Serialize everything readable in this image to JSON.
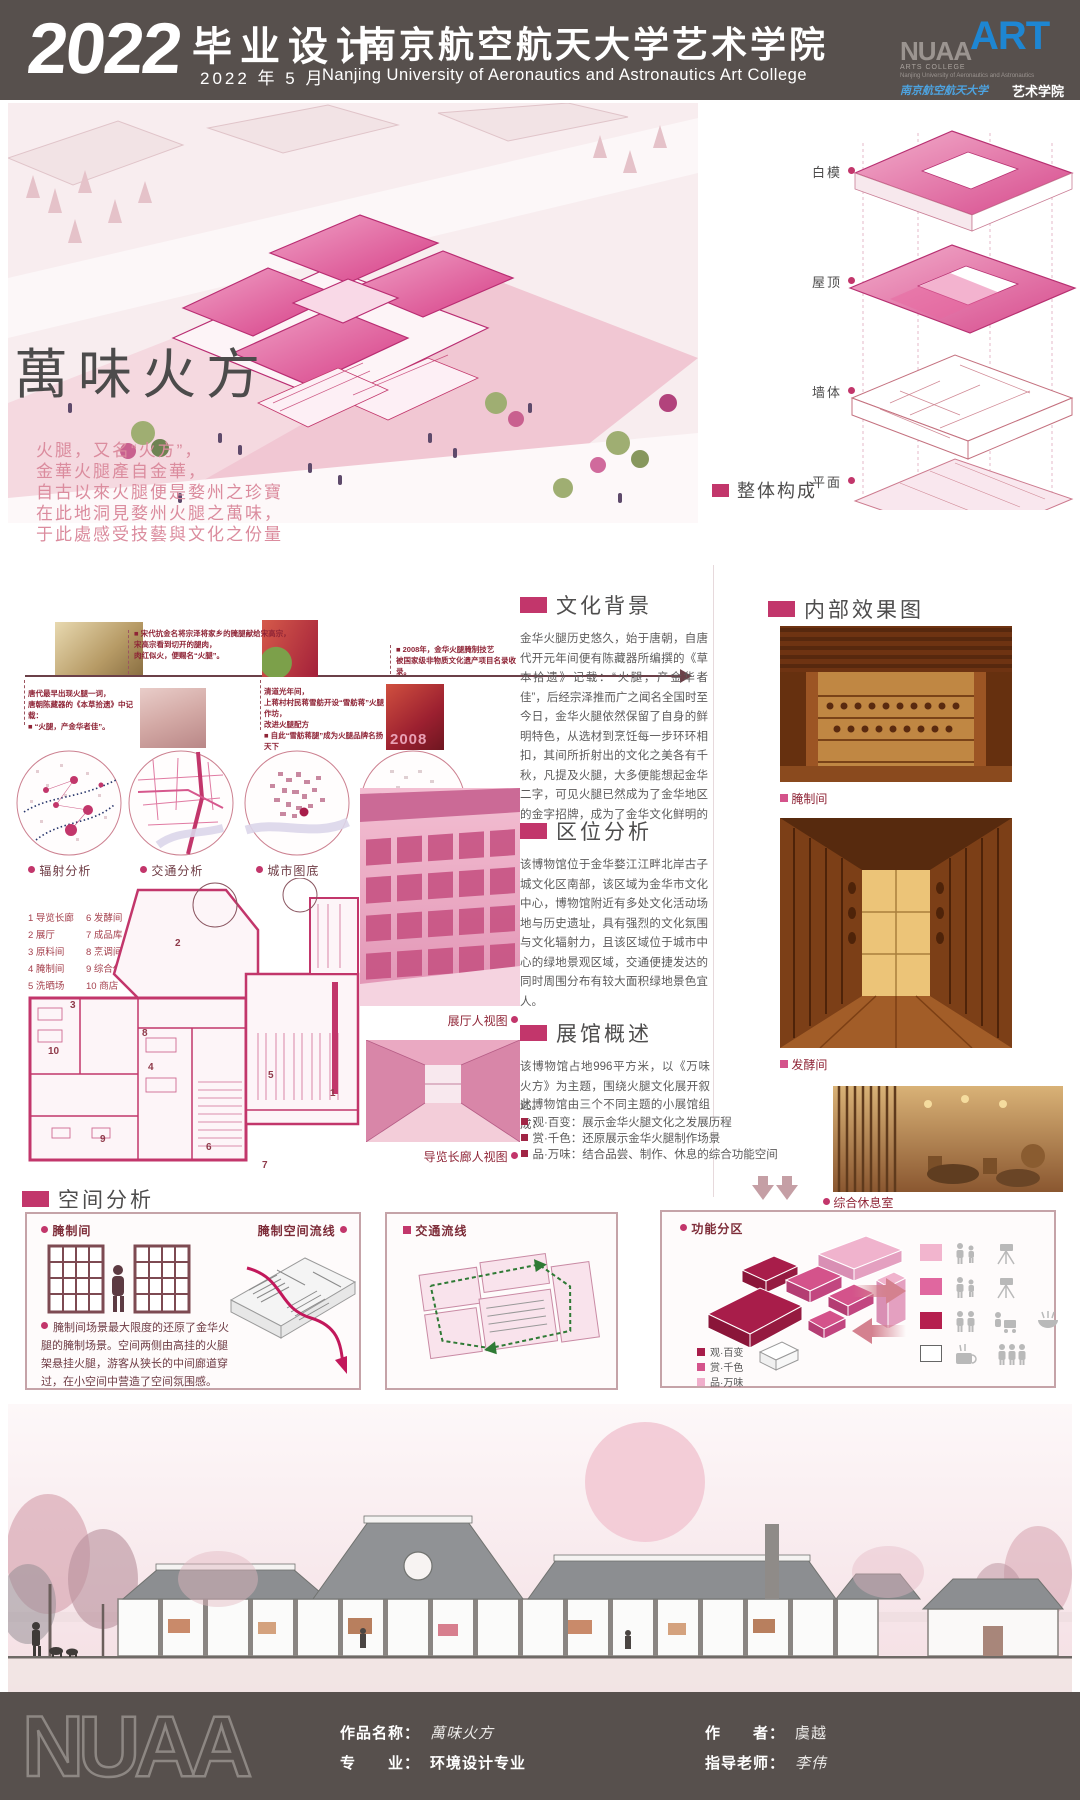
{
  "colors": {
    "accent": "#c2366b",
    "header_bar": "#57504d",
    "timeline_red": "#8f2436",
    "zone_dark": "#a81d4a",
    "zone_mid": "#d4538b",
    "zone_light": "#f0aecb",
    "logo_blue": "#1e86d2"
  },
  "header": {
    "year": "2022",
    "title": "毕业设计",
    "date": "2022 年 5 月",
    "school_cn": "南京航空航天大学艺术学院",
    "school_en": "Nanjing University of Aeronautics and Astronautics Art College",
    "logo": {
      "nuaa": "NUAA",
      "art": "ART",
      "arts_college": "ARTS COLLEGE",
      "uni_line": "Nanjing University  of Aeronautics and Astronautics",
      "calligraphy": "南京航空航天大学",
      "art_college": "艺术学院"
    }
  },
  "hero": {
    "title": "萬味火方",
    "lines": [
      "火腿，又名“火方”，",
      "金華火腿產自金華，",
      "自古以來火腿便是婺州之珍寶",
      "在此地洞見婺州火腿之萬味，",
      "于此處感受技藝與文化之份量"
    ]
  },
  "exploded": {
    "labels": [
      "白模",
      "屋顶",
      "墙体",
      "平面"
    ],
    "section": "整体构成"
  },
  "timeline": {
    "ev_tang": "唐代最早出现火腿一词，\n唐朝陈藏器的《本草拾遗》中记载：\n■ “火腿，产金华者佳”。",
    "ev_song": "■ 宋代抗金名将宗泽将家乡的腌腿献给宋高宗，\n宋高宗看到切开的腿肉，\n肉红似火，便赐名“火腿”。",
    "ev_qing": "清道光年间，\n上蒋村村民蒋雪舫开设“雪舫蒋”火腿作坊，\n改进火腿配方\n■ 自此“雪舫蒋腿”成为火腿品牌名扬天下",
    "ev_2008": "■ 2008年，金华火腿腌制技艺\n被国家级非物质文化遗产项目名录收录。",
    "ham_year": "2008"
  },
  "circles": {
    "labels": [
      "辐射分析",
      "交通分析",
      "城市图底",
      "绿地分析"
    ]
  },
  "plan": {
    "legend_col1": [
      "1  导览长廊",
      "2  展厅",
      "3  原料间",
      "4  腌制间",
      "5  洗晒场"
    ],
    "legend_col2": [
      "6  发酵间",
      "7  成品库",
      "8  烹调间",
      "9  综合休息室",
      "10  商店"
    ],
    "numbers": [
      "1",
      "2",
      "3",
      "4",
      "5",
      "6",
      "7",
      "8",
      "9",
      "10"
    ]
  },
  "views": {
    "hall": "展厅人视图",
    "corridor": "导览长廊人视图"
  },
  "sections": {
    "culture": {
      "title": "文化背景",
      "body": "金华火腿历史悠久，始于唐朝，自唐代开元年间便有陈藏器所编撰的《草本拾遗》记载：“火腿，产金华者佳”，后经宗泽推而广之闻名全国时至今日，金华火腿依然保留了自身的鲜明特色，从选材到烹饪每一步环环相扣，其间所折射出的文化之美各有千秋，凡提及火腿，大多便能想起金华二字，可见火腿已然成为了金华地区的金字招牌，成为了金华文化鲜明的底色。"
    },
    "location": {
      "title": "区位分析",
      "body": "该博物馆位于金华婺江江畔北岸古子城文化区南部，该区域为金华市文化中心，博物馆附近有多处文化活动场地与历史遗址，具有强烈的文化氛围与文化辐射力，且该区域位于城市中心的绿地景观区域，交通便捷发达的同时周围分布有较大面积绿地景色宜人。"
    },
    "overview": {
      "title": "展馆概述",
      "body1": "该博物馆占地996平方米，以《万味火方》为主题，围绕火腿文化展开叙述。",
      "body2": "此博物馆由三个不同主题的小展馆组成：",
      "bullets": [
        "观·百变：展示金华火腿文化之发展历程",
        "赏·千色：还原展示金华火腿制作场景",
        "品·万味：结合品尝、制作、休息的综合功能空间"
      ]
    }
  },
  "interior": {
    "title": "内部效果图",
    "photo1": "腌制间",
    "photo2": "发酵间",
    "photo3": "综合休息室"
  },
  "space": {
    "title": "空间分析",
    "box1": {
      "label": "腌制间",
      "flow": "腌制空间流线",
      "desc": "腌制间场景最大限度的还原了金华火腿的腌制场景。空间两侧由高挂的火腿架悬挂火腿，游客从狭长的中间廊道穿过，在小空间中营造了空间氛围感。"
    },
    "box2": {
      "label": "交通流线"
    },
    "box3": {
      "label": "功能分区",
      "legend": [
        "观·百变",
        "赏·千色",
        "品·万味"
      ]
    }
  },
  "footer": {
    "nuaa": "NUAA",
    "work_label": "作品名称：",
    "work_value": "萬味火方",
    "major_label": "专　　业：",
    "major_value": "环境设计专业",
    "author_label": "作　　者：",
    "author_value": "虞越",
    "advisor_label": "指导老师：",
    "advisor_value": "李伟"
  }
}
